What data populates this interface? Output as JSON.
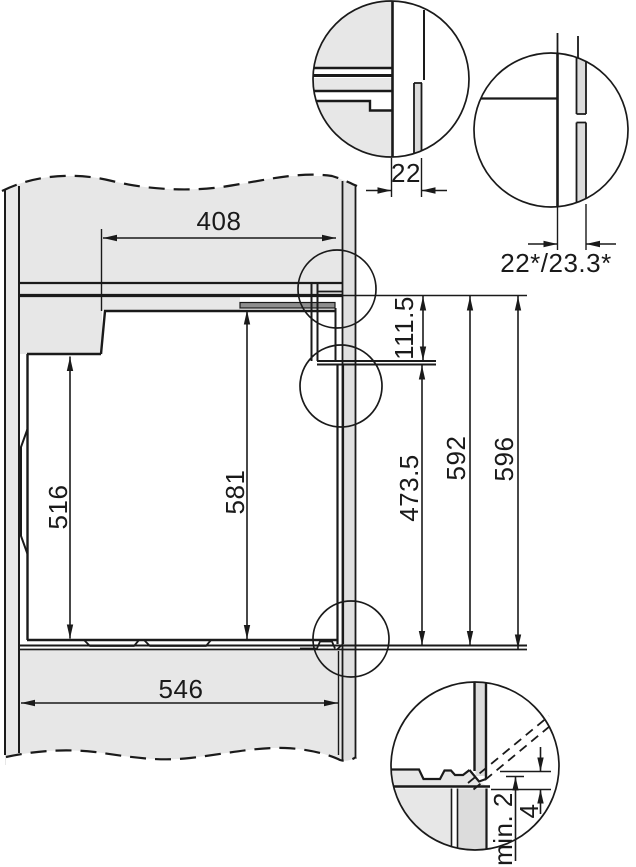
{
  "drawing": {
    "title": "built-in-oven-installation-cross-section",
    "dims": {
      "top_depth": "408",
      "front_panel": "22",
      "front_panel_variant": "22*/23.3*",
      "control_panel_height": "111.5",
      "door_height": "473.5",
      "front_height": "592",
      "niche_height": "596",
      "interior_height": "516",
      "body_height": "581",
      "bottom_depth": "546",
      "min_clearance": "min. 2",
      "door_gap": "4"
    },
    "colors": {
      "line": "#1a1a1a",
      "panel_fill": "#e7e7e7",
      "trim_fill": "#8e8e8e",
      "background": "#ffffff"
    }
  }
}
